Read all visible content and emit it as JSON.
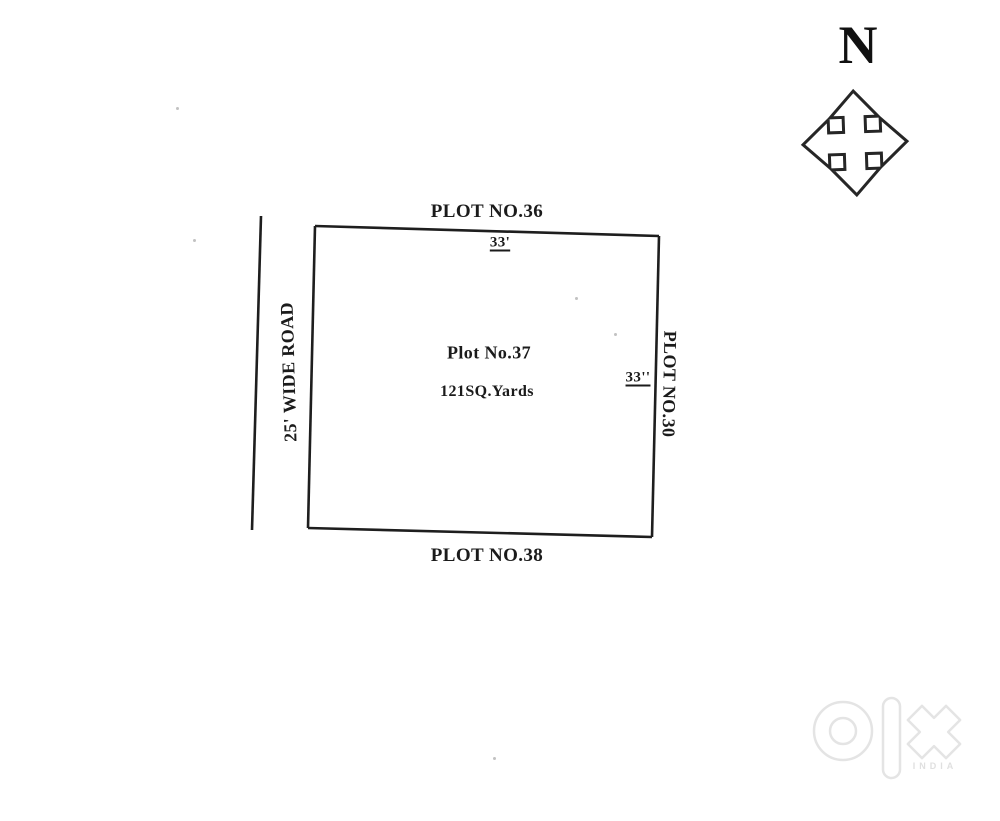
{
  "page": {
    "background": "#ffffff",
    "ink_color": "#1e1e1e",
    "watermark_color": "#e4e4e4"
  },
  "compass": {
    "north_label": "N"
  },
  "plot": {
    "name": "Plot No.37",
    "area": "121SQ.Yards",
    "top_dimension": "33'",
    "right_dimension": "33''"
  },
  "neighbors": {
    "north": "PLOT NO.36",
    "east": "PLOT NO.30",
    "south": "PLOT NO.38",
    "west_road": "25' WIDE ROAD"
  },
  "watermark": {
    "brand": "olx",
    "country": "INDIA"
  }
}
